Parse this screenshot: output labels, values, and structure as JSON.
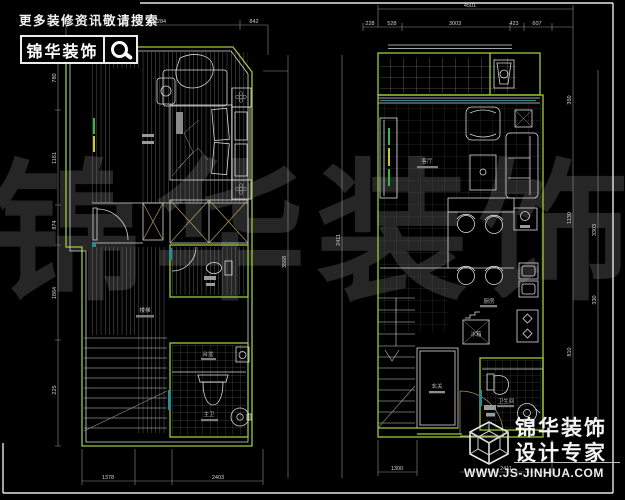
{
  "header": {
    "search_text": "更多装修资讯敬请搜索",
    "brand": "锦华装饰"
  },
  "watermark": "锦华装饰",
  "brand_badge": {
    "brand": "锦华装饰",
    "tagline": "设计专家",
    "url": "WWW.JS-JINHUA.COM"
  },
  "left_plan": {
    "labels": {
      "stairs": "楼梯",
      "counter": "台盆",
      "bath_main": "主卫"
    },
    "dims": {
      "top": [
        "4284",
        "842"
      ],
      "bottom": [
        "1378",
        "2403"
      ],
      "side": [
        "780",
        "1161",
        "874",
        "1864",
        "225"
      ]
    }
  },
  "mid_dims": [
    "3568",
    "2411"
  ],
  "right_plan": {
    "labels": {
      "living": "客厅",
      "kitchen": "厨房",
      "fridge": "冰箱",
      "entry": "玄关",
      "bath": "卫生间"
    },
    "dims": {
      "top_total": "4501",
      "top": [
        "228",
        "528",
        "3003",
        "423",
        "607"
      ],
      "right_inner": [
        "350",
        "1130",
        "810"
      ],
      "right_outer": [
        "3303",
        "330"
      ],
      "bottom": [
        "1300",
        "2411"
      ]
    }
  },
  "colors": {
    "background": "#000000",
    "wall_green": "#9ccb3b",
    "line_white": "#d9d9d9",
    "accent_teal": "#2e8b8b",
    "accent_tan": "#b0a060",
    "watermark_gray": "#262626"
  }
}
